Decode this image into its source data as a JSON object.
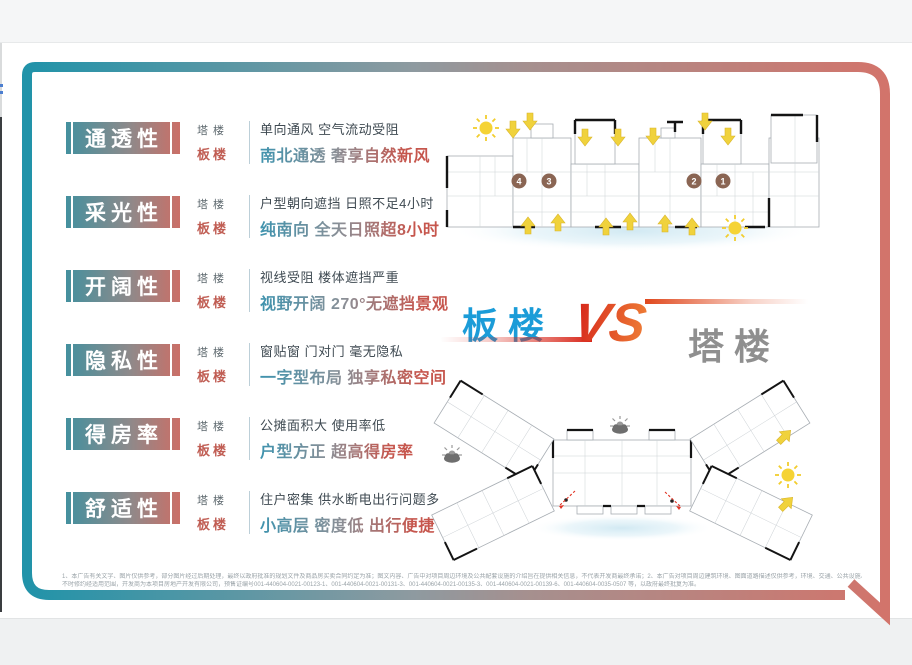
{
  "versus": {
    "left": "板楼",
    "vs": "VS",
    "right": "塔楼"
  },
  "comparison_rows": [
    {
      "title": "通透性",
      "tower_label": "塔楼",
      "slab_label": "板楼",
      "tower_text": "单向通风 空气流动受阻",
      "slab_text": "南北通透 奢享自然新风"
    },
    {
      "title": "采光性",
      "tower_label": "塔楼",
      "slab_label": "板楼",
      "tower_text": "户型朝向遮挡 日照不足4小时",
      "slab_text": "纯南向 全天日照超8小时"
    },
    {
      "title": "开阔性",
      "tower_label": "塔楼",
      "slab_label": "板楼",
      "tower_text": "视线受阻 楼体遮挡严重",
      "slab_text": "视野开阔 270°无遮挡景观"
    },
    {
      "title": "隐私性",
      "tower_label": "塔楼",
      "slab_label": "板楼",
      "tower_text": "窗贴窗 门对门 毫无隐私",
      "slab_text": "一字型布局 独享私密空间"
    },
    {
      "title": "得房率",
      "tower_label": "塔楼",
      "slab_label": "板楼",
      "tower_text": "公摊面积大 使用率低",
      "slab_text": "户型方正 超高得房率"
    },
    {
      "title": "舒适性",
      "tower_label": "塔楼",
      "slab_label": "板楼",
      "tower_text": "住户密集 供水断电出行问题多",
      "slab_text": "小高层 密度低 出行便捷"
    }
  ],
  "slab_plan": {
    "units": [
      "4",
      "3",
      "2",
      "1"
    ]
  },
  "icons": {
    "sun": "sun-icon",
    "blocked_sun_cloud": "cloud-blocked-sun-icon",
    "airflow_arrow": "airflow-arrow-icon",
    "sightline_eye": "eye-sightline-icon",
    "unit_badge": "unit-number-badge"
  },
  "disclaimer": {
    "line1": "1、本广告有关文字、图片仅供参考，部分图片经过后期处理，最终以政府批准的规划文件及商品房买卖合同约定为准；图文内容、广告中对项目周边环境及公共配套设施的介绍旨在提供相关信息，不代表开发商最终承诺；2、本广告对项目周边建筑环境、图面道路描述仅供参考，环境、交通、公共设施、各类产品及文字介绍，旨在提供相关信息，不意味着本公司对此作出了承诺，容均遵循相关为",
    "line2": "不时修约经适用范围，开发商为本项目房地产开发有限公司，预售证编号001-440604-0021-00123-1、001-440604-0021-00131-3、001-440604-0021-00135-3、001-440604-0021-00139-6、001-440604-0035-0507 等，以政府最终批复为准。"
  },
  "colors": {
    "frame_teal": "#2193a9",
    "frame_red": "#d2746b",
    "accent_blue": "#1b9cd8",
    "accent_gray": "#8f8f8f",
    "vs_red": "#d8261a",
    "slab_red": "#c05d53",
    "tower_gray": "#5d686e",
    "arrow_yellow": "#f0d23c",
    "unit_brown": "#8a6553",
    "shadow_blue": "#cfe8f2"
  }
}
